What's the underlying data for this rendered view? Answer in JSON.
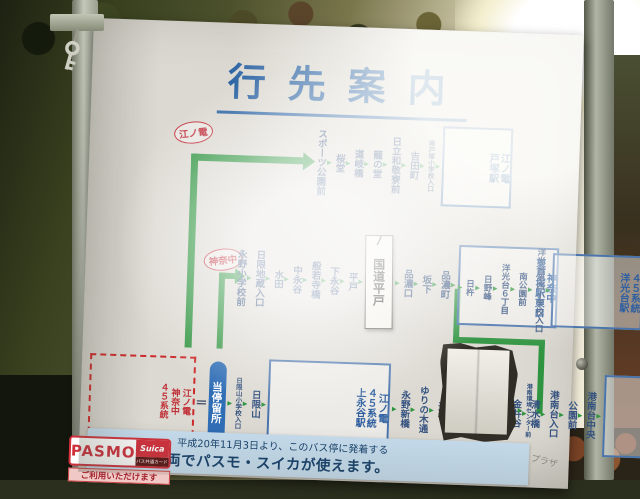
{
  "sign": {
    "title": "行先案内",
    "routes": {
      "top": {
        "badge": "江ノ電",
        "stops": [
          {
            "name": "スポーツ公園前"
          },
          {
            "name": "桜堂"
          },
          {
            "name": "道岐橋"
          },
          {
            "name": "龍の堂"
          },
          {
            "name": "日立和敬寮前"
          },
          {
            "name": "吉田町"
          },
          {
            "name": "南戸塚小学校入口",
            "small": true
          }
        ],
        "terminal": [
          "江ノ電",
          "戸塚駅"
        ]
      },
      "middle": {
        "badge": "神奈中",
        "stops_before_paper": [
          {
            "name": "永野小学校前"
          },
          {
            "name": "日限地蔵入口"
          },
          {
            "name": "水田"
          },
          {
            "name": "中永谷"
          },
          {
            "name": "般若寺橋"
          },
          {
            "name": "下永谷"
          },
          {
            "name": "平戸"
          }
        ],
        "pasted_label": "国道平戸",
        "stops_after_paper": [
          {
            "name": "品濃口"
          },
          {
            "name": "坂下"
          },
          {
            "name": "品濃町"
          }
        ],
        "terminal": [
          "神奈中",
          "東戸塚駅東口"
        ]
      },
      "branch": {
        "stops": [
          {
            "name": "日杵"
          },
          {
            "name": "日野峰"
          },
          {
            "name": "洋光台６丁目"
          },
          {
            "name": "南公園前"
          },
          {
            "name": "洋光台第四小学校入口",
            "small": true
          }
        ],
        "terminal": [
          "４５系統",
          "洋光台駅"
        ]
      },
      "bottom": {
        "legend": [
          "江ノ電",
          "神奈中",
          "４５系統"
        ],
        "equals": "＝",
        "this_stop": "当停留所",
        "stops_1": [
          {
            "name": "日限山小学校入口",
            "small": true
          },
          {
            "name": "日限山"
          }
        ],
        "terminal_1": [
          "江ノ電",
          "４５系統",
          "上永谷駅"
        ],
        "stops_2": [
          {
            "name": "永野新橋"
          },
          {
            "name": "ゆりの木通"
          },
          {
            "name": "天谷"
          },
          {
            "name": "すずかけ通"
          },
          {
            "name": "深田橋"
          },
          {
            "name": "みやのくぼ"
          },
          {
            "name": "金井谷"
          },
          {
            "name": "清水橋"
          },
          {
            "name": "港南台入口"
          },
          {
            "name": "公園前"
          },
          {
            "name": "港南台中央"
          }
        ],
        "terminal_2": [
          "４５系統",
          "港南台駅"
        ],
        "stop_after_paper": "港南環境センター前"
      }
    },
    "banner": {
      "line1": "平成20年11月3日より、このバス停に発着する",
      "line2": "すべての車両でパスモ・スイカが使えます。",
      "side_note": "プラザ"
    },
    "pasmo": {
      "logo": "PASMO",
      "suica": "Suica",
      "suica_sub": "バス共通カード",
      "strip": "ご利用いただけます"
    }
  },
  "colors": {
    "line_green": "#2f9440",
    "stop_text_blue": "#33517f",
    "title_blue": "#2f66a5",
    "badge_red": "#c23440",
    "banner_bg": "#c6ddee",
    "pasmo_red": "#d0303c",
    "board_bg": "#dcd9d2"
  }
}
